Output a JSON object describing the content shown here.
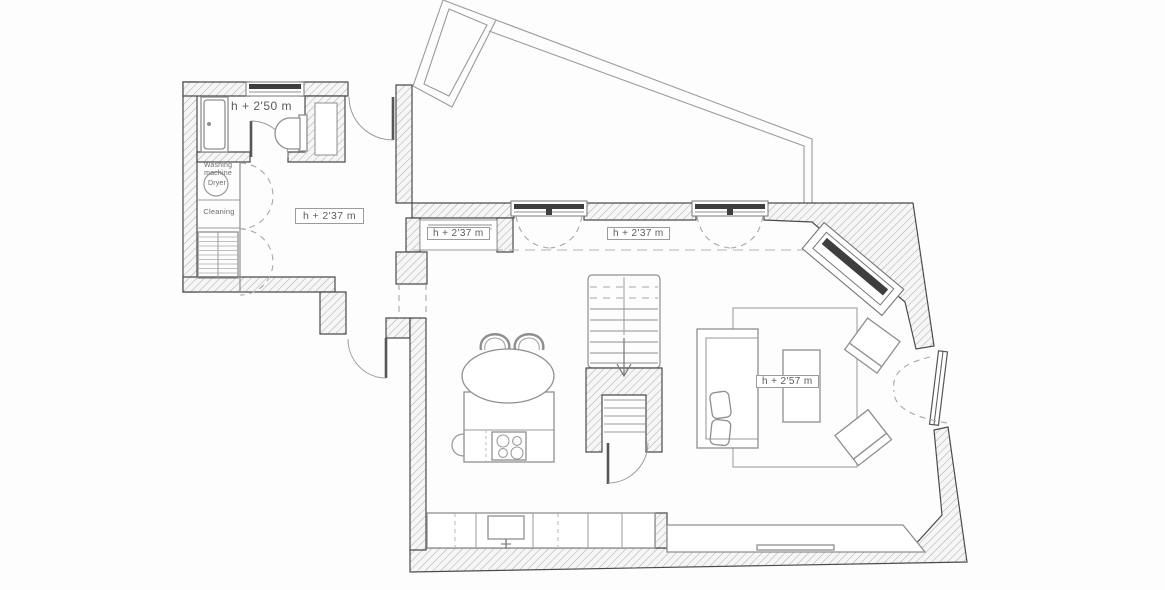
{
  "drawing": {
    "type": "architectural-floor-plan",
    "palette": {
      "background": "#fdfdfd",
      "wall_line": "#4b4b4b",
      "hatch_line": "#ababab",
      "furniture_line": "#8f8f8f",
      "glazing_dark": "#3e3e3e",
      "dashed_line": "#a8a8a8",
      "label_border": "#9c9c9c",
      "label_text": "#5c5c5c"
    }
  },
  "labels": {
    "bath_height": "h + 2'50 m",
    "hall_height": "h + 2'37 m",
    "niche_height": "h + 2'37 m",
    "room_height": "h + 2'37 m",
    "living_height": "h + 2'57 m"
  },
  "annotations": {
    "washing_line1": "Washing",
    "washing_line2": "machine",
    "dryer": "Dryer",
    "cleaning": "Cleaning"
  }
}
